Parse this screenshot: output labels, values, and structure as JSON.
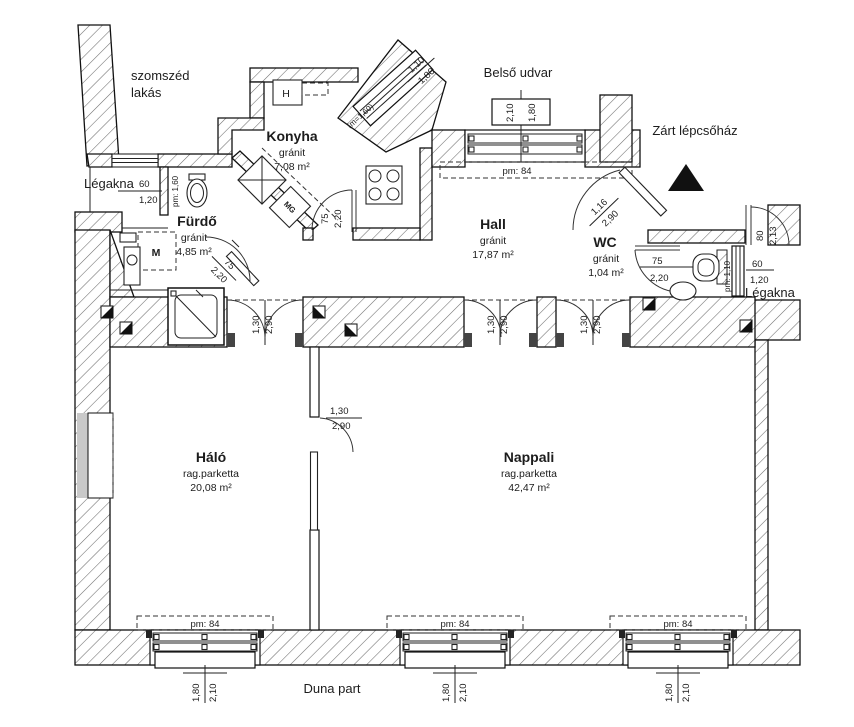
{
  "labels": {
    "neighbor_l1": "szomszéd",
    "neighbor_l2": "lakás",
    "legakna_left": "Légakna",
    "belso_udvar": "Belső udvar",
    "lepcsohaz": "Zárt lépcsőház",
    "legakna_right": "Légakna",
    "duna": "Duna part"
  },
  "rooms": {
    "konyha": {
      "name": "Konyha",
      "floor": "gránit",
      "area": "7,08 m²"
    },
    "furdo": {
      "name": "Fürdő",
      "floor": "gránit",
      "area": "4,85 m²"
    },
    "hall": {
      "name": "Hall",
      "floor": "gránit",
      "area": "17,87 m²"
    },
    "wc": {
      "name": "WC",
      "floor": "gránit",
      "area": "1,04 m²"
    },
    "halo": {
      "name": "Háló",
      "floor": "rag.parketta",
      "area": "20,08 m²"
    },
    "nappali": {
      "name": "Nappali",
      "floor": "rag.parketta",
      "area": "42,47 m²"
    }
  },
  "fixtures": {
    "m": "M",
    "mg": "MG",
    "h": "H"
  },
  "dims": {
    "legakna_left_w": "60",
    "legakna_left_h": "1,20",
    "legakna_left_pm": "pm: 1,60",
    "diag_win_a": "1,10",
    "diag_win_b": "1,80",
    "diag_win_m": "(m=1,60)",
    "top_win_a": "2,10",
    "top_win_b": "1,80",
    "top_win_pm": "pm: 84",
    "entry_a": "1,16",
    "entry_b": "2,90",
    "konyha_door_a": "75",
    "konyha_door_b": "2,20",
    "furdo_door_a": "75",
    "furdo_door_b": "2,20",
    "wc_door_a": "75",
    "wc_door_b": "2,20",
    "right_door_a": "80",
    "right_door_b": "2,13",
    "legakna_right_w": "60",
    "legakna_right_h": "1,20",
    "legakna_right_pm": "pm: 1,10",
    "halo_door_a": "1,30",
    "halo_door_b": "2,90",
    "napp1_a": "1,30",
    "napp1_b": "2,90",
    "napp2_a": "1,30",
    "napp2_b": "2,90",
    "hn_door_a": "1,30",
    "hn_door_b": "2,90",
    "bottom_windows": [
      {
        "pm": "pm: 84",
        "h": "1,80",
        "w": "2,10"
      },
      {
        "pm": "pm: 84",
        "h": "1,80",
        "w": "2,10"
      },
      {
        "pm": "pm: 84",
        "h": "1,80",
        "w": "2,10"
      }
    ]
  }
}
